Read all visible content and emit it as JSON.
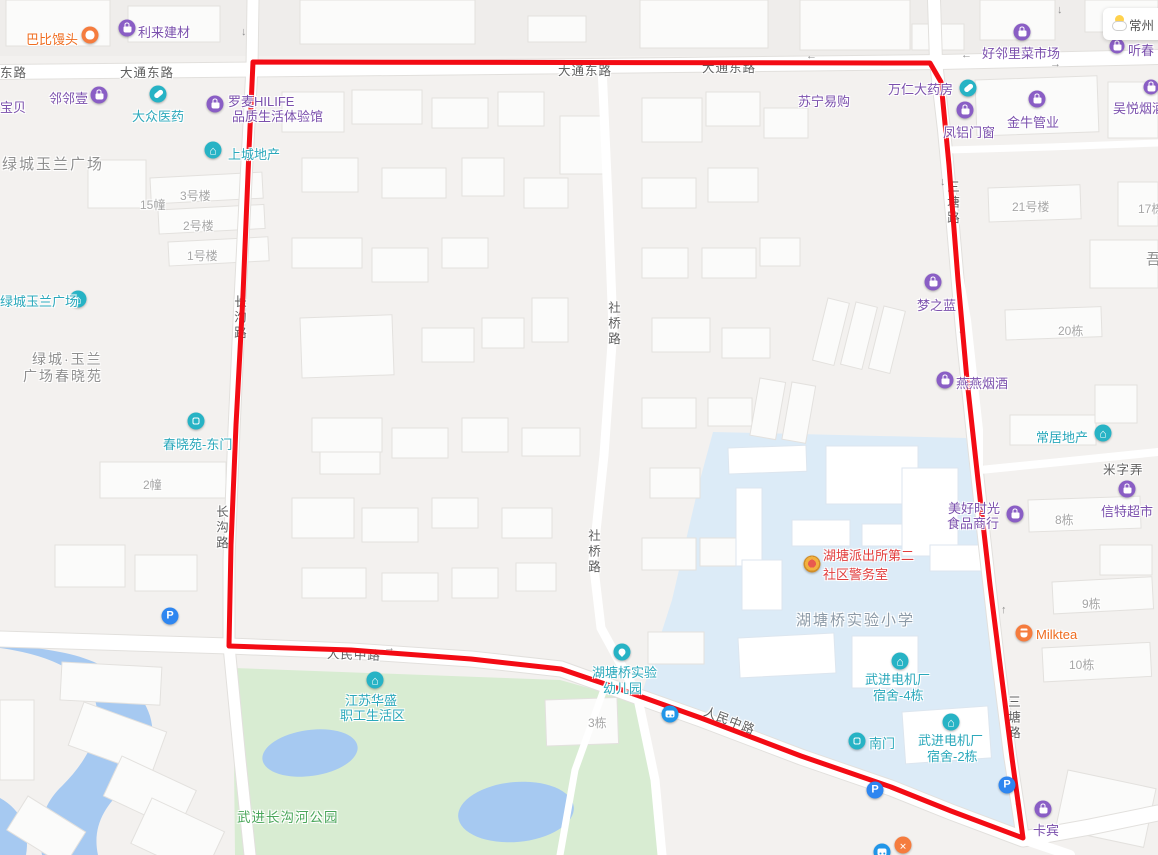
{
  "map_type": "street-map",
  "colors": {
    "route": "#f30b14",
    "water": "#a6c9f1",
    "park": "#d8ecd2",
    "campus": "#dcebf7",
    "road": "#ffffff",
    "poi_purple": "#7b50ad",
    "poi_teal": "#2aa8bb",
    "poi_orange": "#ef6c1f"
  },
  "route": {
    "color": "#f30b14",
    "points": "253,62 930,63 941,82 949,165 958,280 967,380 978,480 990,585 1001,672 1012,758 1023,838 951,811 891,787 801,756 701,718 611,686 561,669 471,659 351,650 229,646 231,545 236,425 243,295 249,150 253,62"
  },
  "weather_widget": {
    "city": "常州"
  },
  "transport": {
    "parking_label": "P"
  },
  "road_labels": [
    {
      "text": "东路"
    },
    {
      "text": "大通东路"
    },
    {
      "text": "大通东路"
    },
    {
      "text": "大通东路"
    },
    {
      "text": "长沟路"
    },
    {
      "text": "长沟路"
    },
    {
      "text": "社桥路"
    },
    {
      "text": "社桥路"
    },
    {
      "text": "三塘路"
    },
    {
      "text": "三塘路"
    },
    {
      "text": "人民中路"
    },
    {
      "text": "人民中路"
    },
    {
      "text": "米字弄"
    }
  ],
  "area_labels": [
    {
      "text": "绿城玉兰广场"
    },
    {
      "line1": "绿城·玉兰",
      "line2": "广场春晓苑"
    },
    {
      "text": "湖塘桥实验小学"
    },
    {
      "text": "武进长沟河公园"
    },
    {
      "text": "吾"
    }
  ],
  "building_labels": [
    "15幢",
    "3号楼",
    "2号楼",
    "1号楼",
    "2幢",
    "21号楼",
    "17栋",
    "20栋",
    "8栋",
    "9栋",
    "10栋",
    "3栋"
  ],
  "pois": [
    {
      "name": "巴比馒头"
    },
    {
      "name": "利来建材"
    },
    {
      "name": "好邻里菜市场"
    },
    {
      "name": "听春"
    },
    {
      "name": "邻邻壹"
    },
    {
      "name": "宝贝"
    },
    {
      "name": "大众医药"
    },
    {
      "line1": "罗麦HILIFE",
      "line2": "品质生活体验馆"
    },
    {
      "name": "上城地产"
    },
    {
      "name": "苏宁易购"
    },
    {
      "name": "万仁大药房"
    },
    {
      "name": "凤铝门窗"
    },
    {
      "name": "金牛管业"
    },
    {
      "name": "吴悦烟酒"
    },
    {
      "name": "梦之蓝"
    },
    {
      "name": "燕燕烟酒"
    },
    {
      "name": "常居地产"
    },
    {
      "line1": "美好时光",
      "line2": "食品商行"
    },
    {
      "name": "信特超市"
    },
    {
      "name": "绿城玉兰广场"
    },
    {
      "name": "春晓苑-东门"
    },
    {
      "name": "Milktea"
    },
    {
      "name": "卡宾"
    },
    {
      "line1": "江苏华盛",
      "line2": "职工生活区"
    },
    {
      "line1": "湖塘桥实验",
      "line2": "幼儿园"
    },
    {
      "line1": "湖塘派出所第二",
      "line2": "社区警务室"
    },
    {
      "line1": "武进电机厂",
      "line2": "宿舍-4栋"
    },
    {
      "name": "南门"
    },
    {
      "line1": "武进电机厂",
      "line2": "宿舍-2栋"
    }
  ],
  "arrows": [
    {
      "glyph": "↓"
    },
    {
      "glyph": "←"
    },
    {
      "glyph": "←"
    },
    {
      "glyph": "→"
    },
    {
      "glyph": "↓"
    },
    {
      "glyph": "↓"
    },
    {
      "glyph": "↓"
    },
    {
      "glyph": "↓"
    },
    {
      "glyph": "↑"
    },
    {
      "glyph": "↓"
    },
    {
      "glyph": "←"
    },
    {
      "glyph": "→"
    }
  ]
}
